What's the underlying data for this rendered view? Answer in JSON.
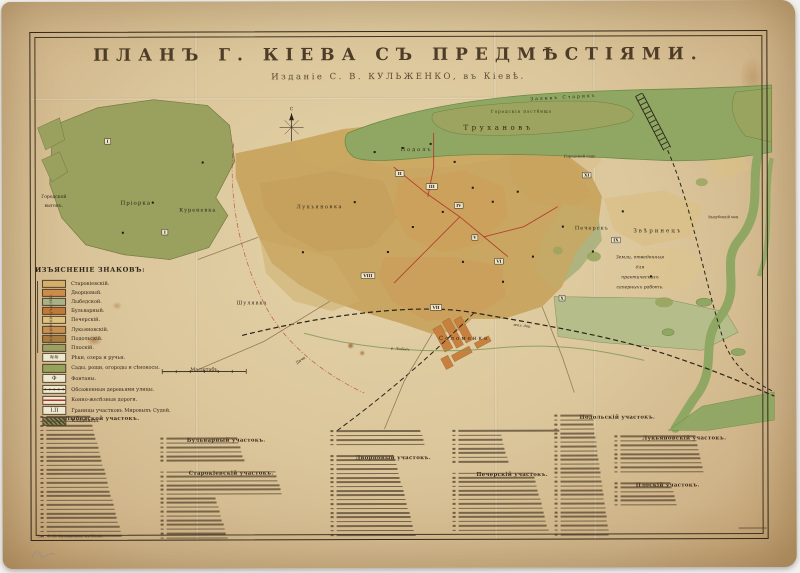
{
  "title": {
    "main": "ПЛАНЪ Г. КІЕВА СЪ ПРЕДМѢСТІЯМИ.",
    "sub": "Изданіе С. В. КУЛЬЖЕНКО, въ Кіевѣ."
  },
  "colors": {
    "paper": "#dcc79c",
    "paper_dark": "#c3a376",
    "ink": "#2e2518",
    "title_ink": "#4d3c27",
    "river": "#8fa763",
    "river_edge": "#6e8a46",
    "suburb": "#9aa05e",
    "city": "#c9a661",
    "sand": "#d9c190",
    "grove": "#96a35c",
    "accent_red": "#b5352a"
  },
  "compass": {
    "letter": "С"
  },
  "scale": {
    "label": "Масштабъ"
  },
  "imprint": {
    "left": "Лит. С. В. Кульженко, въ Кіевѣ."
  },
  "legend": {
    "title": "ИЗЪЯСНЕНІЕ ЗНАКОВЪ:",
    "side_label": "Полицейскіе участки.",
    "districts": [
      {
        "name": "Старокіевскій.",
        "color": "#d4b06a"
      },
      {
        "name": "Дворцовый.",
        "color": "#cd8c4a"
      },
      {
        "name": "Лыбедской.",
        "color": "#a8b188"
      },
      {
        "name": "Бульварный.",
        "color": "#c07a38"
      },
      {
        "name": "Печерскій.",
        "color": "#dec27c"
      },
      {
        "name": "Лукьяновскій.",
        "color": "#c89050"
      },
      {
        "name": "Подольскій.",
        "color": "#a97c42"
      },
      {
        "name": "Плоскій.",
        "color": "#9ba063"
      }
    ],
    "symbols": [
      {
        "type": "water",
        "label": "Рѣки, озера и ручьи.",
        "glyph": "≋≋"
      },
      {
        "type": "green",
        "label": "Сады, рощи, огороды и сѣнокосы.",
        "glyph": ""
      },
      {
        "type": "fountain",
        "label": "Фонтаны.",
        "glyph": "Ф"
      },
      {
        "type": "trees",
        "label": "Обсаженныя деревьями улицы.",
        "glyph": ""
      },
      {
        "type": "tram",
        "label": "Конно-желѣзныя дороги.",
        "glyph": ""
      },
      {
        "type": "boundary",
        "label": "Границы участковъ Мировыхъ Судей.",
        "glyph": "I.II"
      },
      {
        "type": "cemetery",
        "label": "Кладбища.",
        "glyph": ""
      }
    ]
  },
  "map": {
    "labels": [
      {
        "t": "Заливъ  Старикъ",
        "x": 562,
        "y": 98,
        "s": 4.5,
        "ls": 2,
        "r": -3
      },
      {
        "t": "Городскія пастбища",
        "x": 520,
        "y": 112,
        "s": 4,
        "ls": 1
      },
      {
        "t": "Трухановъ",
        "x": 497,
        "y": 129,
        "s": 7,
        "ls": 3.5
      },
      {
        "t": "Городской",
        "x": 52,
        "y": 196,
        "s": 4.5
      },
      {
        "t": "выгонъ.",
        "x": 52,
        "y": 205,
        "s": 4.5
      },
      {
        "t": "Пріорка",
        "x": 134,
        "y": 203,
        "s": 5.5,
        "ls": 1
      },
      {
        "t": "Куреневка",
        "x": 196,
        "y": 210,
        "s": 5,
        "ls": 1
      },
      {
        "t": "Лукьяновка",
        "x": 318,
        "y": 207,
        "s": 5,
        "ls": 1.5
      },
      {
        "t": "Подолъ",
        "x": 415,
        "y": 150,
        "s": 5,
        "ls": 2
      },
      {
        "t": "Городской садъ",
        "x": 578,
        "y": 157,
        "s": 3.8
      },
      {
        "t": "Шулявка",
        "x": 250,
        "y": 303,
        "s": 5,
        "ls": 1
      },
      {
        "t": "Соломенка",
        "x": 462,
        "y": 339,
        "s": 5.5,
        "ls": 2
      },
      {
        "t": "Печерскъ",
        "x": 590,
        "y": 229,
        "s": 5,
        "ls": 1
      },
      {
        "t": "Звѣринецъ",
        "x": 656,
        "y": 232,
        "s": 5.5,
        "ls": 2
      },
      {
        "t": "Земли, отведенныя",
        "x": 638,
        "y": 258,
        "s": 4.5,
        "it": 1
      },
      {
        "t": "для",
        "x": 638,
        "y": 268,
        "s": 4.5,
        "it": 1
      },
      {
        "t": "практическихъ",
        "x": 638,
        "y": 278,
        "s": 4.5,
        "it": 1
      },
      {
        "t": "саперныхъ работъ.",
        "x": 638,
        "y": 288,
        "s": 4.5,
        "it": 1
      },
      {
        "t": "Выдубецкій мон.",
        "x": 722,
        "y": 218,
        "s": 3.5
      },
      {
        "t": "Дача",
        "x": 299,
        "y": 360,
        "s": 4,
        "r": -35
      },
      {
        "t": "жел. дор.",
        "x": 520,
        "y": 326,
        "s": 3.5,
        "r": 7,
        "it": 1
      },
      {
        "t": "р. Лыбедь",
        "x": 398,
        "y": 349,
        "s": 3.5,
        "r": 5,
        "it": 1
      }
    ],
    "numerals": [
      [
        "I",
        106,
        141
      ],
      [
        "I",
        163,
        232
      ],
      [
        "II",
        398,
        174
      ],
      [
        "III",
        430,
        187
      ],
      [
        "IV",
        457,
        206
      ],
      [
        "V",
        473,
        238
      ],
      [
        "VI",
        497,
        262
      ],
      [
        "VII",
        434,
        308
      ],
      [
        "VIII",
        366,
        276
      ],
      [
        "IX",
        614,
        241
      ],
      [
        "X",
        560,
        299
      ],
      [
        "XI",
        585,
        176
      ]
    ]
  },
  "index": {
    "columns": [
      {
        "blocks": [
          {
            "header": "Лыбедской участокъ.",
            "count": 28
          }
        ]
      },
      {
        "blocks": [
          {
            "header": "Бульварный участокъ.",
            "count": 6
          },
          {
            "header": "Старокіевскій участокъ.",
            "count": 16
          }
        ]
      },
      {
        "blocks": [
          {
            "header": null,
            "count": 4
          },
          {
            "header": "Дворцовый участокъ.",
            "count": 19
          }
        ]
      },
      {
        "blocks": [
          {
            "header": null,
            "count": 8
          },
          {
            "header": "Печерскій участокъ.",
            "count": 14
          }
        ]
      },
      {
        "blocks": [
          {
            "header": "Подольскій участокъ.",
            "count": 28
          }
        ]
      },
      {
        "blocks": [
          {
            "header": "Лукьяновскій участокъ.",
            "count": 9
          },
          {
            "header": "Плоскій участокъ.",
            "count": 6
          }
        ]
      }
    ]
  }
}
